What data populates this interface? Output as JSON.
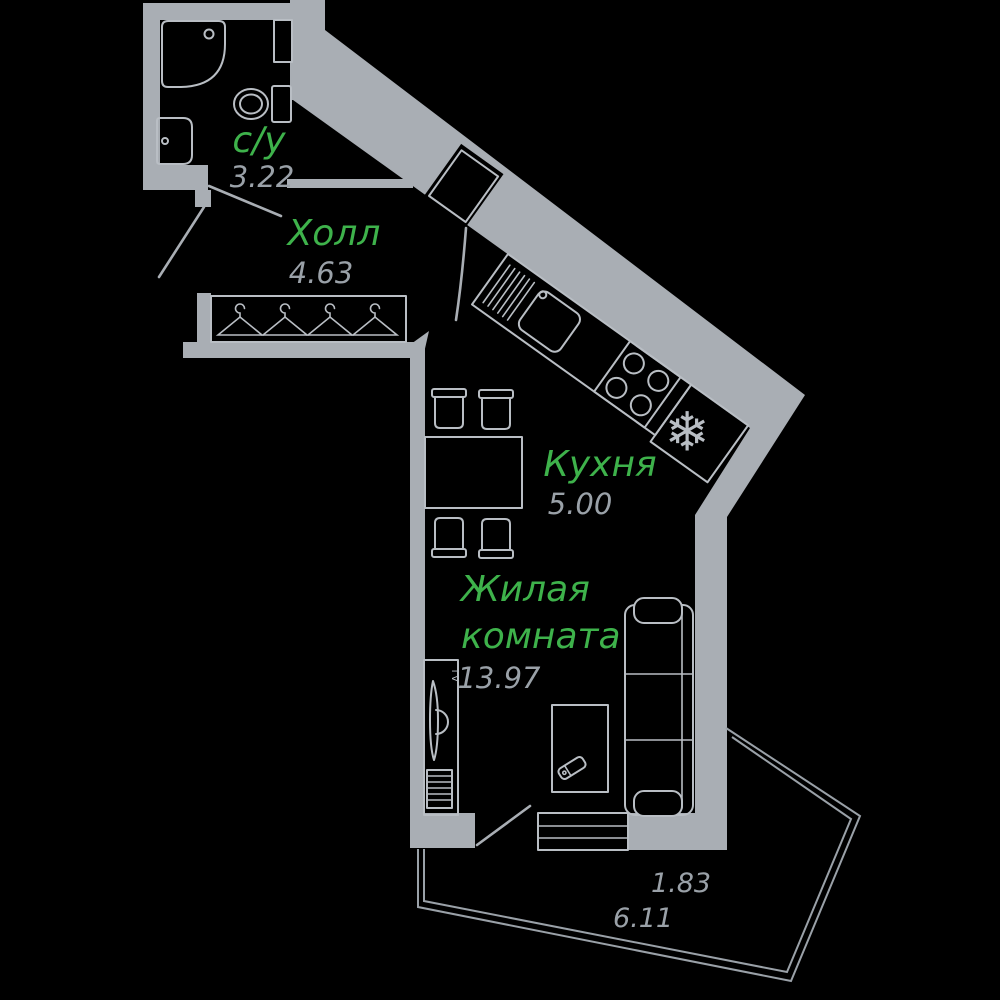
{
  "plan": {
    "colors": {
      "background": "#000000",
      "wall": "#a9aeb4",
      "furniture": "#b9bec4",
      "room_name": "#3eb24b",
      "area_text": "#9aa1a8"
    },
    "rooms": [
      {
        "id": "bathroom",
        "name": "с/у",
        "area": "3.22"
      },
      {
        "id": "hall",
        "name": "Холл",
        "area": "4.63"
      },
      {
        "id": "kitchen",
        "name": "Кухня",
        "area": "5.00"
      },
      {
        "id": "living-room",
        "name": "Жилая комната",
        "name_line1": "Жилая",
        "name_line2": "комната",
        "area": "13.97"
      }
    ],
    "balcony": {
      "area_reduced": "1.83",
      "area_full": "6.11"
    },
    "icons": {
      "tv_label": "TV",
      "fridge_snowflake": "❄"
    }
  }
}
